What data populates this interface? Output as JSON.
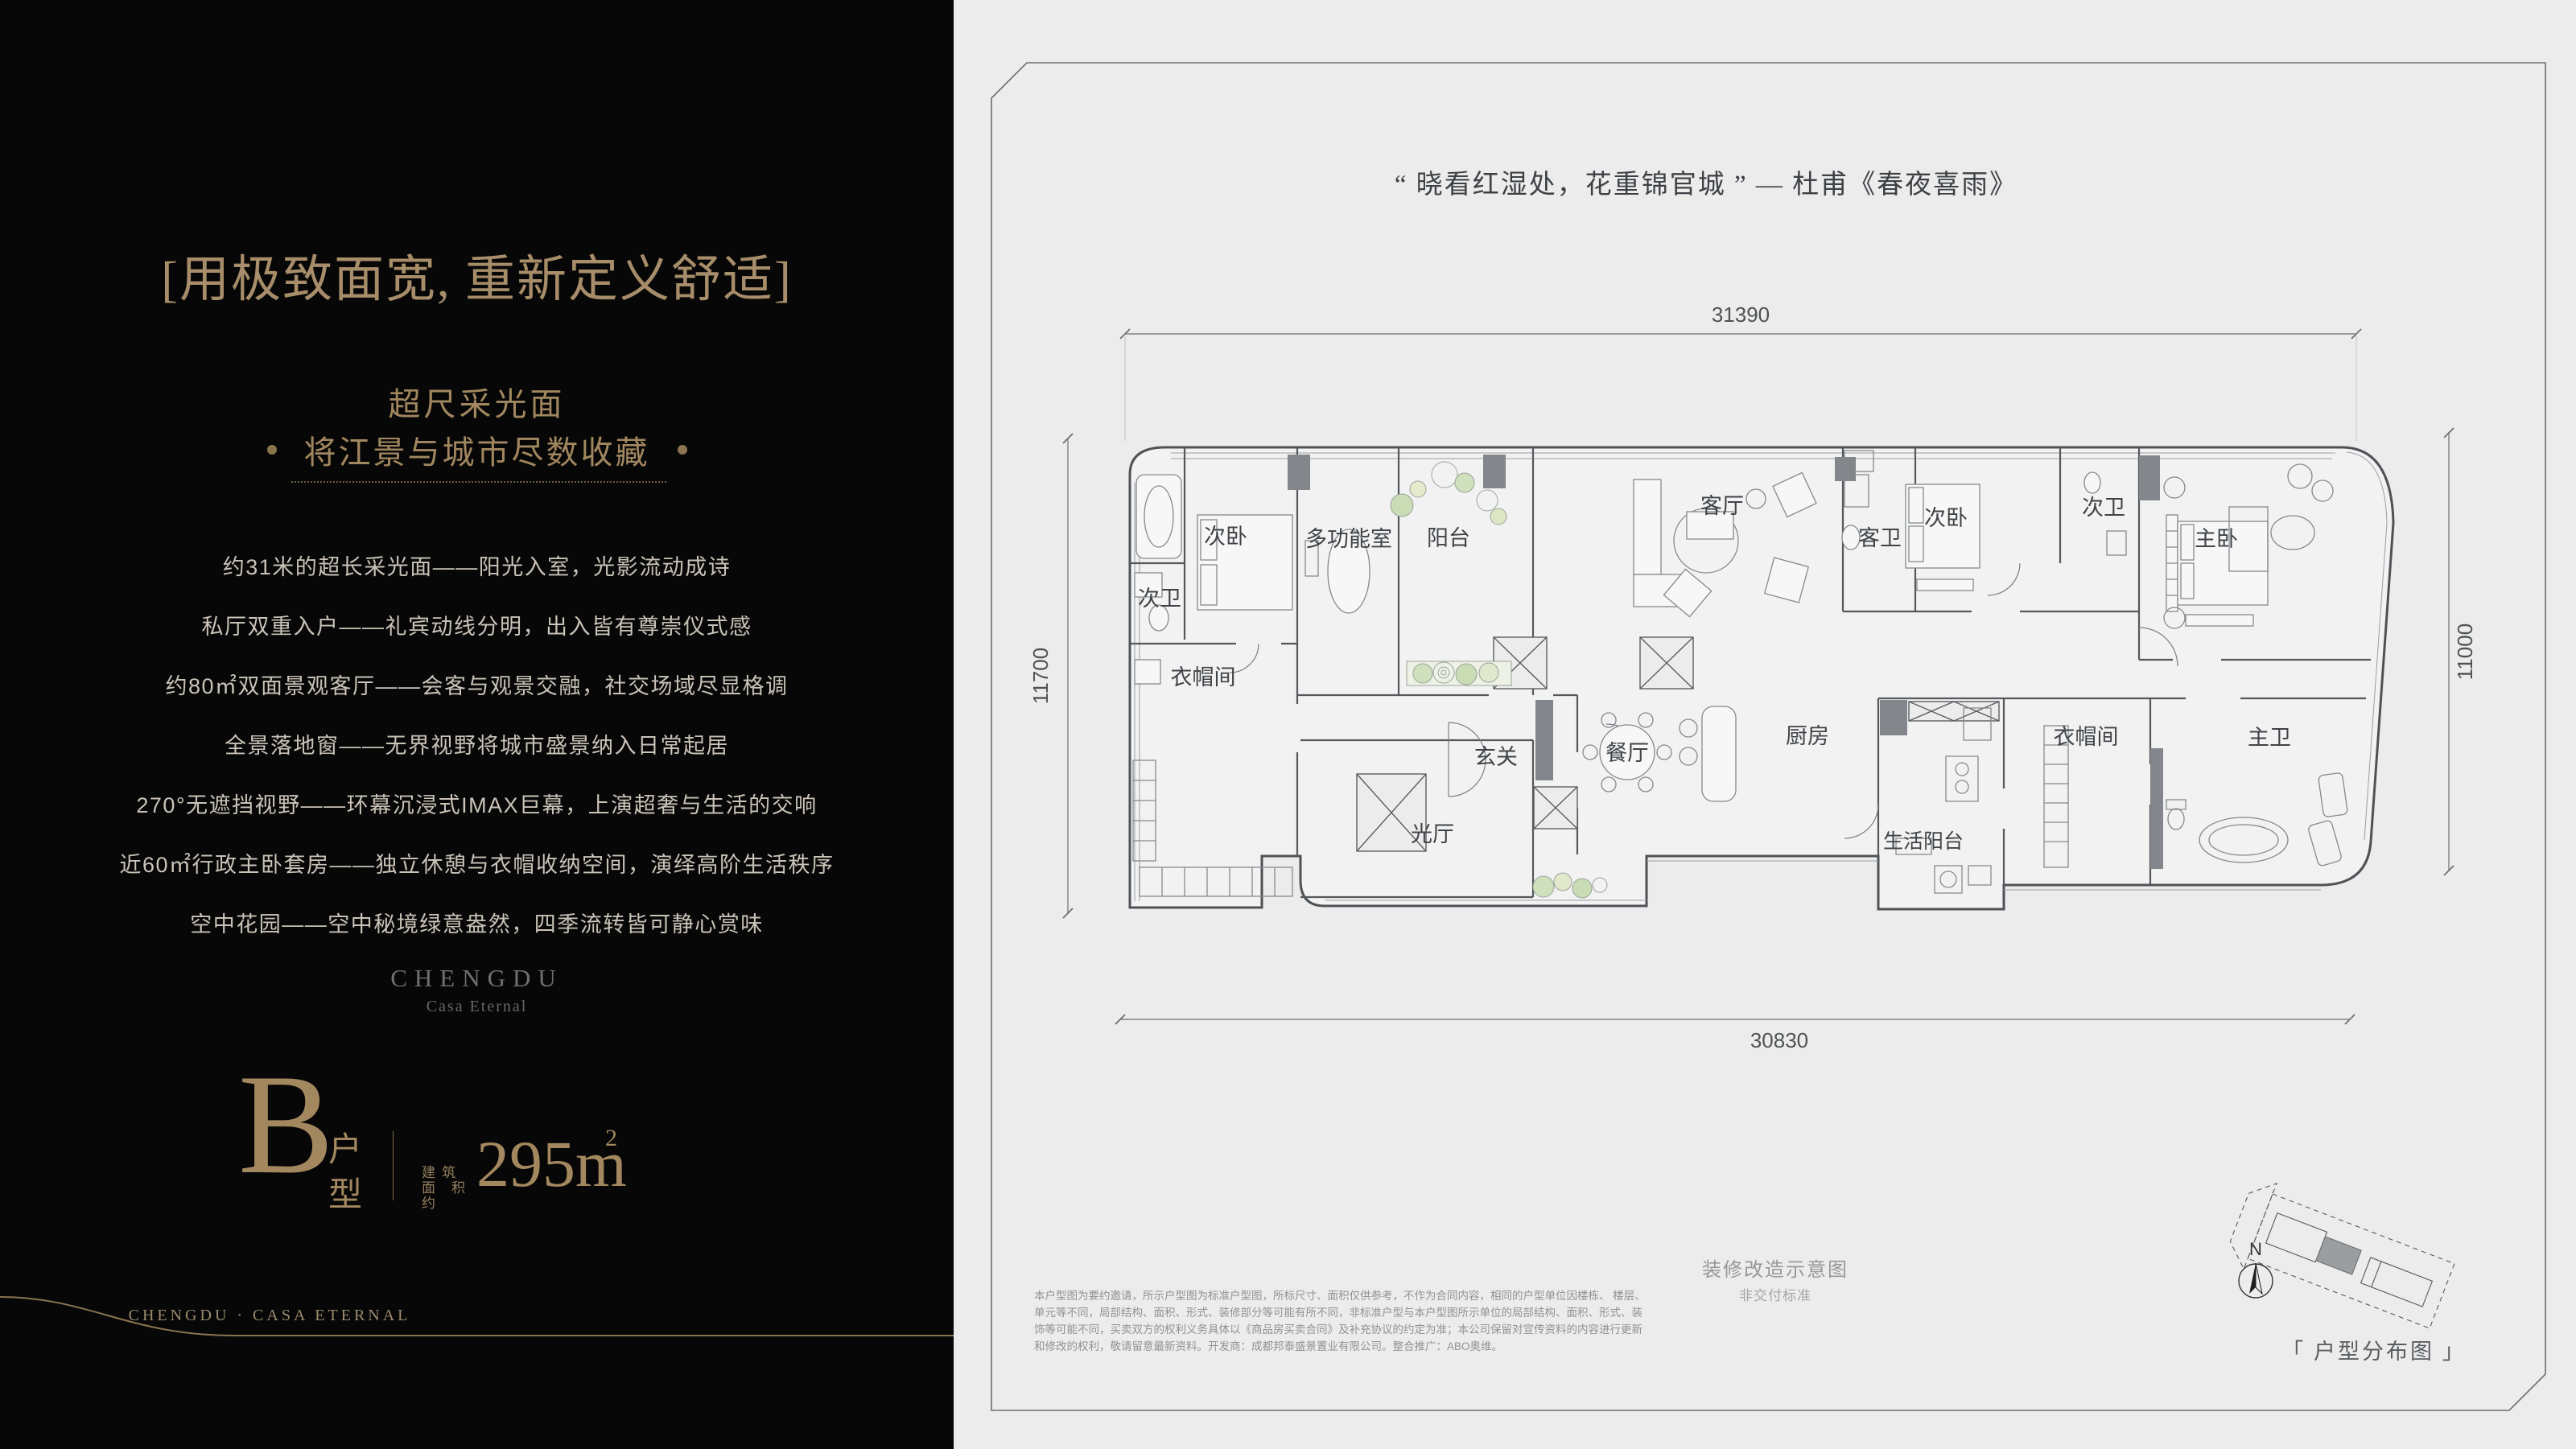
{
  "colors": {
    "panel_black": "#070707",
    "gold": "#a3885f",
    "panel_gray": "#ececec",
    "plan_line": "#4e5256",
    "plant_green": "#cfe0bd"
  },
  "left_panel": {
    "title": "[用极致面宽, 重新定义舒适]",
    "subtitle": "超尺采光面",
    "subtitle2": "将江景与城市尽数收藏",
    "features": [
      "约31米的超长采光面——阳光入室，光影流动成诗",
      "私厅双重入户——礼宾动线分明，出入皆有尊崇仪式感",
      "约80㎡双面景观客厅——会客与观景交融，社交场域尽显格调",
      "全景落地窗——无界视野将城市盛景纳入日常起居",
      "270°无遮挡视野——环幕沉浸式IMAX巨幕，上演超奢与生活的交响",
      "近60㎡行政主卧套房——独立休憩与衣帽收纳空间，演绎高阶生活秩序",
      "空中花园——空中秘境绿意盎然，四季流转皆可静心赏味"
    ],
    "logo": {
      "name": "CHENGDU",
      "sub": "Casa Eternal"
    },
    "unit": {
      "letter": "B",
      "type_line1": "户",
      "type_line2": "型",
      "area_prefix_1": "建 筑",
      "area_prefix_2": "面积约",
      "area": "295m",
      "area_sup": "2"
    },
    "footer": "CHENGDU · CASA ETERNAL"
  },
  "right_panel": {
    "quote": "“ 晓看红湿处，花重锦官城 ” —  杜甫《春夜喜雨》",
    "floorplan": {
      "dimensions": {
        "top": "31390",
        "bottom": "30830",
        "left": "11700",
        "right": "11000"
      },
      "rooms": [
        "次卧",
        "次卫",
        "衣帽间",
        "多功能室",
        "阳台",
        "客厅",
        "客卫",
        "次卧",
        "次卫",
        "主卧",
        "玄关",
        "光厅",
        "餐厅",
        "厨房",
        "衣帽间",
        "主卫",
        "生活阳台"
      ]
    },
    "note_title": "装修改造示意图",
    "note_sub": "非交付标准",
    "disclaimer": [
      "本户型图为要约邀请，所示户型图为标准户型图，所标尺寸、面积仅供参考，不作为合同内容，相同的户型单位因楼栋、 楼层、",
      "单元等不同，局部结构、面积、形式、装修部分等可能有所不同，非标准户型与本户型图所示单位的局部结构、面积、形式、装",
      "饰等可能不同，买卖双方的权利义务具体以《商品房买卖合同》及补充协议的约定为准；本公司保留对宣传资料的内容进行更新",
      "和修改的权利，敬请留意最新资料。开发商：成都邦泰盛景置业有限公司。整合推广：ABO奥维。"
    ],
    "keyplan": {
      "label": "「 户型分布图 」",
      "north": "N"
    }
  }
}
